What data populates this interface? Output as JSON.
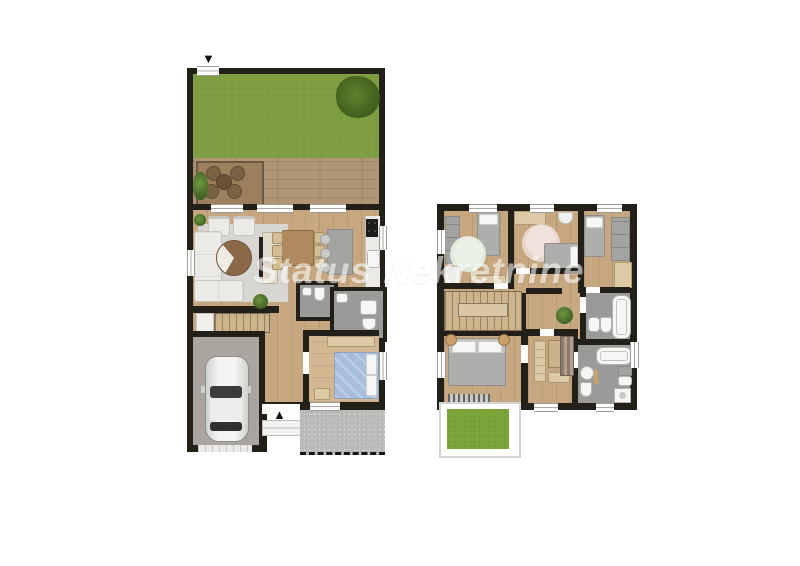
{
  "watermark": {
    "text": "Status Nekretnine"
  },
  "icons": {
    "north_arrow": "▼",
    "entrance_arrow": "▲"
  },
  "palette": {
    "wall": "#222019",
    "wood": "#c6a77f",
    "wood_light": "#d3b891",
    "wood_shelf": "#dcc9a6",
    "table_wood": "#b08a5e",
    "grass": "#7f9d41",
    "balcony_grass": "#7aa437",
    "deck": "#b09674",
    "deck_rug": "#9c7f5c",
    "patio": "#bdbdbb",
    "garage": "#aaa59f",
    "bath": "#9a9a98",
    "rug": "#d8d6d2",
    "rug_mint": "#e2eadc",
    "rug_pink": "#e8d6cc",
    "sofa": "#eceae6",
    "furniture_gray": "#a3a3a1",
    "bed_gray": "#aeaeac",
    "bed_blue": "#a9bedb",
    "fixture_white": "#f6f6f4",
    "plant_green": "#4e7a33",
    "watermark": "#ffffff"
  }
}
